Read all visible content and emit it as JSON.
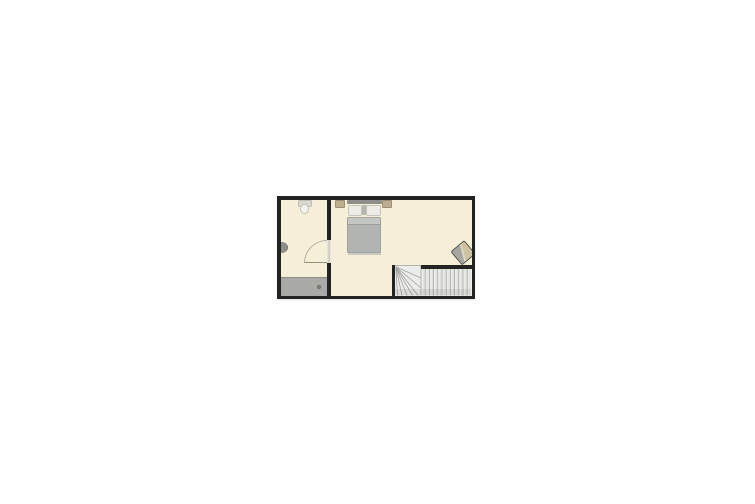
{
  "scene": {
    "type": "floor-plan",
    "background": "#ffffff"
  },
  "floor_plan": {
    "rooms": [
      {
        "name": "bathroom",
        "fixtures": [
          "toilet",
          "wall-sink",
          "shower",
          "shower-drain",
          "door-into-bathroom"
        ]
      },
      {
        "name": "bedroom",
        "furniture": [
          "double-bed",
          "pillow-left",
          "pillow-right",
          "nightstand-left",
          "nightstand-right",
          "armchair"
        ]
      },
      {
        "name": "stairwell",
        "stairs": {
          "style": "winder",
          "straight_treads": 12,
          "winder_treads": 6,
          "entry": "top-left"
        }
      }
    ],
    "colors": {
      "background": "#ffffff",
      "wall": "#232323",
      "floor": "#f6efd8",
      "shower": "#a9a9a5",
      "bed_blanket": "#b2b4b1",
      "bed_headboard": "#8e8f8b",
      "pillow": "#edebe5",
      "nightstand": "#bcad8e",
      "chair_back": "#a6a6a2",
      "chair_seat": "#cfc2a3",
      "stair_tread": "#ececea",
      "stair_line": "#a3a39f"
    }
  }
}
